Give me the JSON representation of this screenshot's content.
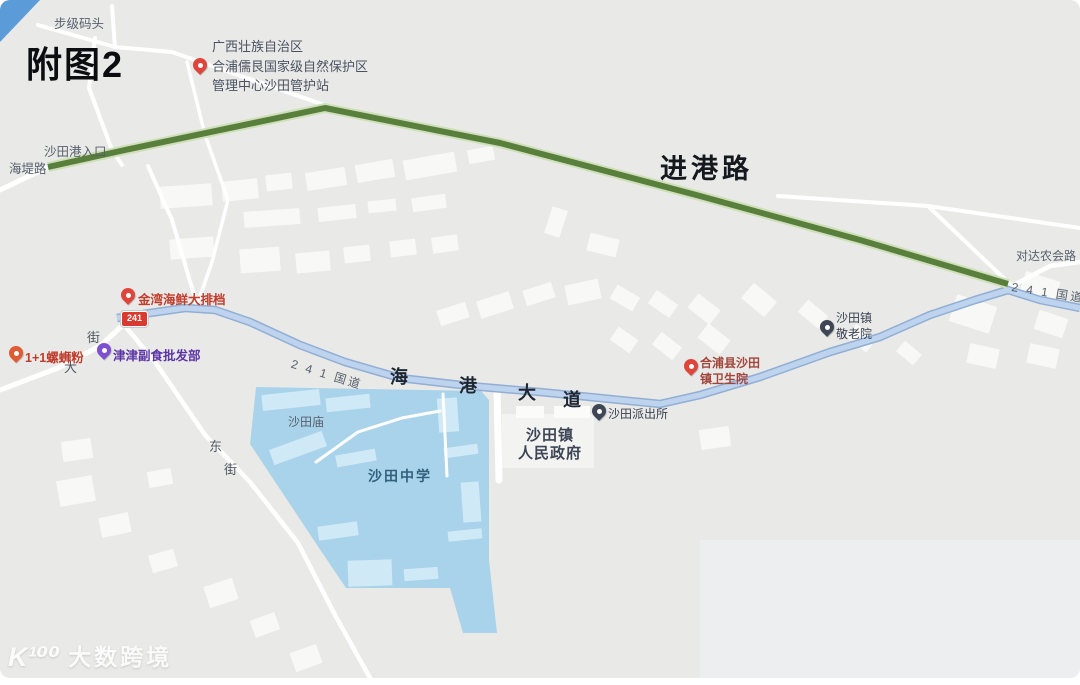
{
  "figure": {
    "title": "附图2"
  },
  "watermark": {
    "logo": "K¹⁰⁰",
    "brand": "大数跨境"
  },
  "colors": {
    "map_bg": "#e9eae8",
    "water_blue": "#5b9bd8",
    "road_green": "#587f3c",
    "road_green_halo": "#cfdfba",
    "road_blue_fill": "#bdd3ee",
    "road_blue_edge": "#92aed4",
    "school_fill": "#a9d3ea",
    "school_building": "#cfe9f6",
    "building_fill": "#f8f8f6",
    "road_white": "#ffffff",
    "shield_red": "#d93a2f",
    "label_dark": "#1c2430",
    "label_gray": "#57606c",
    "poi_red": "#c13b2a",
    "poi_purple": "#5b34a6",
    "poi_dark": "#3a4251",
    "hospital_red": "#a2453a",
    "school_text": "#31607d"
  },
  "roads": {
    "dock": "步级码头",
    "port_entrance": "沙田港入口",
    "haidi_road": "海堤路",
    "jingang_road": "进港路",
    "duida_road": "对达农会路",
    "g241_right": "2 4 1 国道",
    "g241_center": "2 4 1 国道",
    "g241_shield": "241",
    "haigang_avenue": [
      "海",
      "港",
      "大",
      "道"
    ],
    "da_street": [
      "大",
      "街"
    ],
    "dong_street": [
      "东",
      "街"
    ]
  },
  "pois": {
    "reserve": {
      "lines": [
        "广西壮族自治区",
        "合浦儒艮国家级自然保护区",
        "管理中心沙田管护站"
      ]
    },
    "seafood": {
      "label": "金湾海鲜大排档"
    },
    "noodle": {
      "label": "1+1螺蛳粉"
    },
    "grocery": {
      "label": "津津副食批发部"
    },
    "nursing_home": {
      "lines": [
        "沙田镇",
        "敬老院"
      ]
    },
    "hospital": {
      "lines": [
        "合浦县沙田",
        "镇卫生院"
      ]
    },
    "police": {
      "label": "沙田派出所"
    },
    "government": {
      "lines": [
        "沙田镇",
        "人民政府"
      ]
    },
    "temple": {
      "label": "沙田庙"
    },
    "school": {
      "label": "沙田中学"
    }
  }
}
